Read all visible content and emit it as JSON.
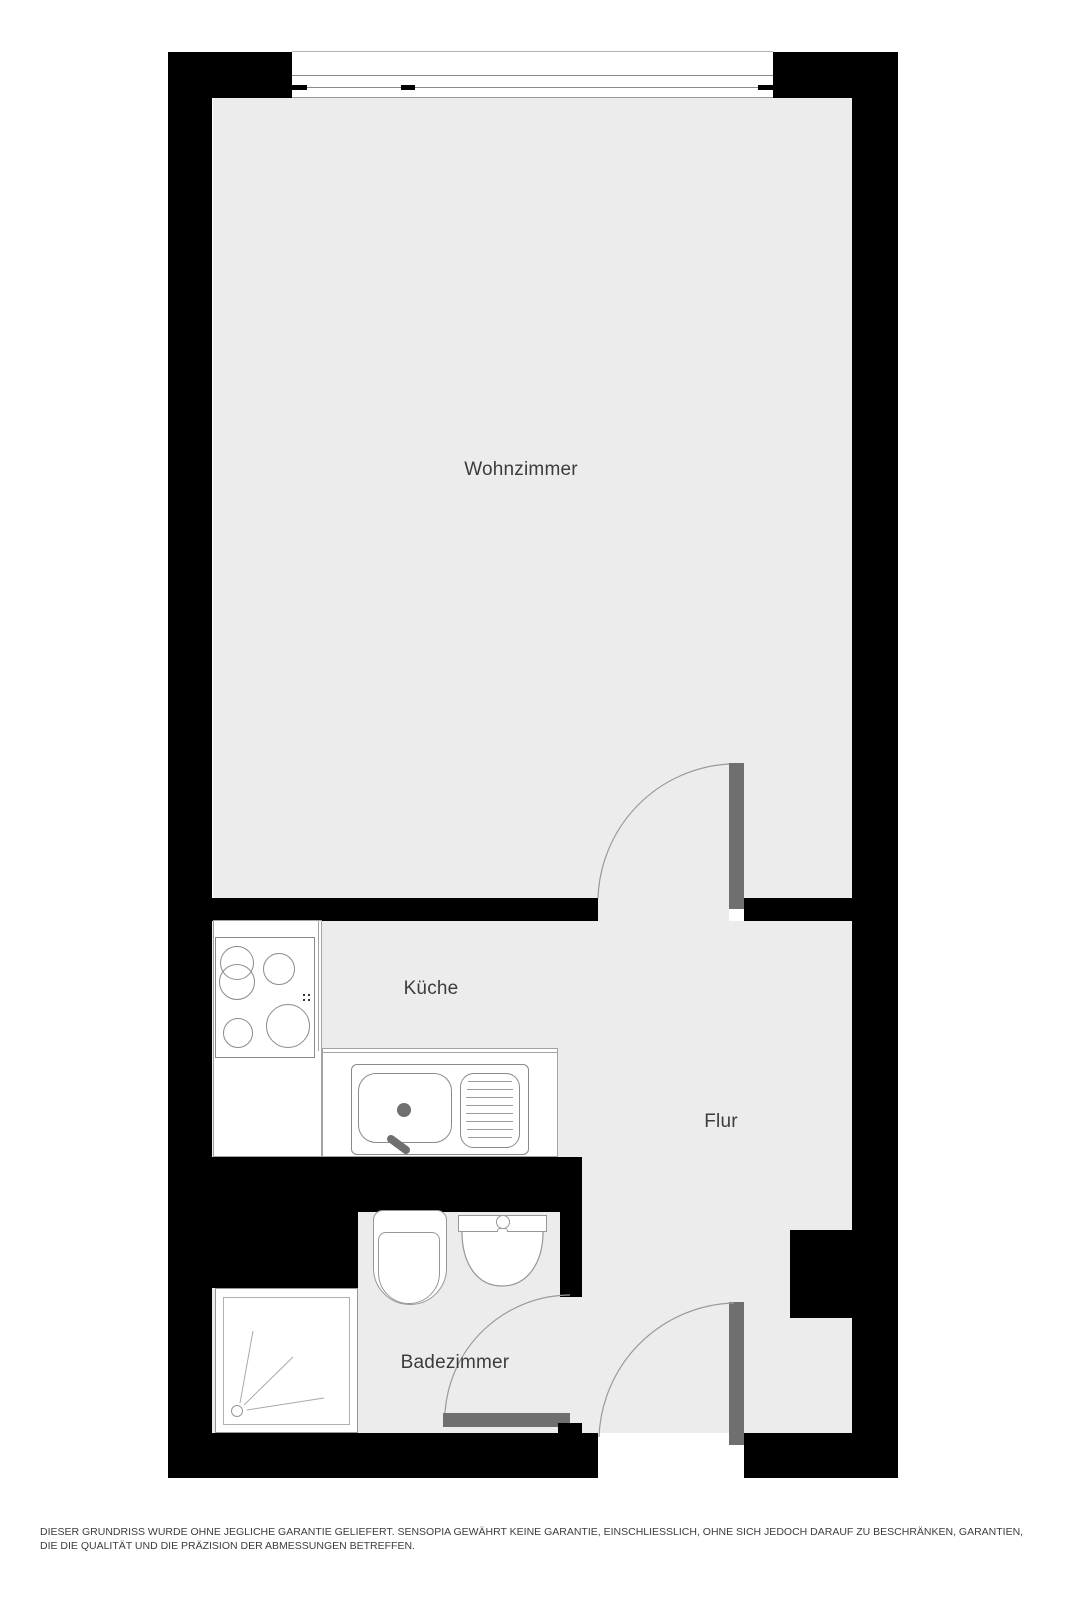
{
  "plan": {
    "rooms": {
      "wohnzimmer": {
        "label": "Wohnzimmer"
      },
      "kueche": {
        "label": "Küche"
      },
      "flur": {
        "label": "Flur"
      },
      "badezimmer": {
        "label": "Badezimmer"
      }
    },
    "fixtures": [
      "window",
      "stove",
      "kitchen-sink",
      "toilet",
      "washbasin",
      "shower",
      "interior-door",
      "entrance-door",
      "bathroom-door"
    ],
    "disclaimer": "DIESER GRUNDRISS WURDE OHNE JEGLICHE GARANTIE GELIEFERT. SENSOPIA GEWÄHRT KEINE GARANTIE, EINSCHLIESSLICH, OHNE SICH JEDOCH DARAUF ZU BESCHRÄNKEN, GARANTIEN, DIE DIE QUALITÄT UND DIE PRÄZISION DER ABMESSUNGEN BETREFFEN.",
    "colors": {
      "wall": "#000000",
      "floor": "#ececec",
      "door_leaf": "#6f6f6f",
      "fixture_outline": "#979797",
      "label_text": "#3c3c3c",
      "background": "#ffffff"
    }
  }
}
